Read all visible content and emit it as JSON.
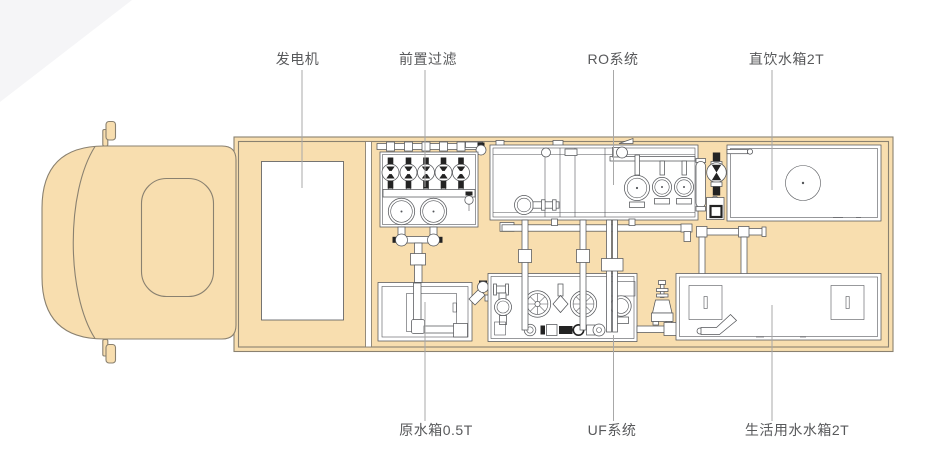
{
  "diagram": {
    "type": "water-treatment-truck-top-view-plan",
    "callouts": [
      {
        "id": "generator",
        "text": "发电机"
      },
      {
        "id": "prefilter",
        "text": "前置过滤"
      },
      {
        "id": "ro-system",
        "text": "RO系统"
      },
      {
        "id": "drinking-tank",
        "text": "直饮水箱2T"
      },
      {
        "id": "raw-water-tank",
        "text": "原水箱0.5T"
      },
      {
        "id": "uf-system",
        "text": "UF系统"
      },
      {
        "id": "domestic-tank",
        "text": "生活用水水箱2T"
      }
    ],
    "colors": {
      "background": "#FFFFFF",
      "corner_wedge": "#F5F5F7",
      "truck_fill": "#F8DEAF",
      "truck_outline": "#8A8170",
      "equipment_line": "#54565A",
      "accent_black": "#232323",
      "label_text": "#58595B",
      "leader_line": "#A8A8A8"
    }
  }
}
